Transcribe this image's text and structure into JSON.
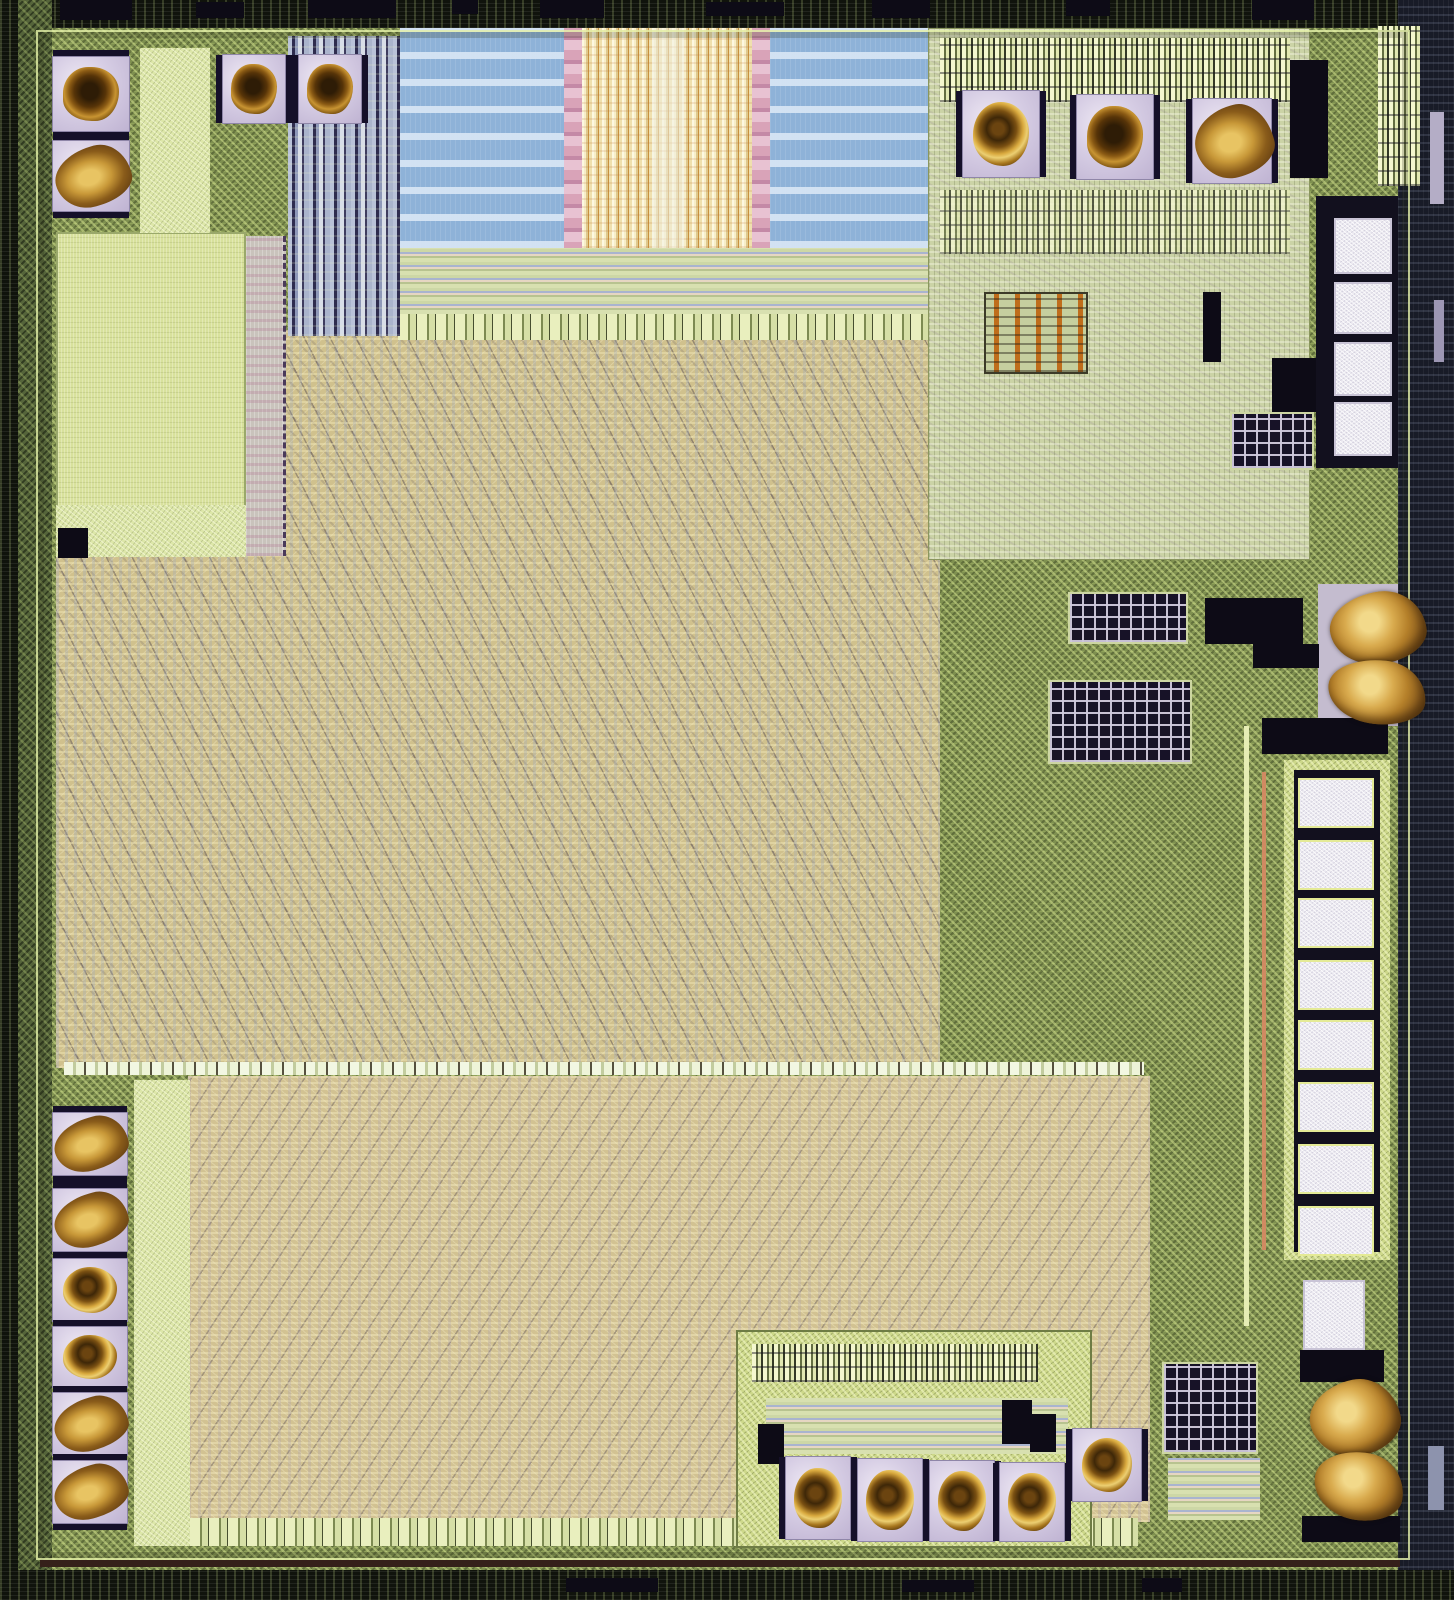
{
  "image": {
    "type": "integrated-circuit die photograph (microscope die shot)",
    "description": "Die photo of a mixed-signal integrated circuit: dark scribe-line border, olive-green seal ring, large tan standard-cell logic fabric split by a pale horizontal routing strip, blue metal capacitor banks with a gold interdigitated structure at top center, pale green memory array at top left, analog macro with resistor and via arrays at top right, wire-bonded gold ball pads on the top, left and bottom edges, gold bond residue smears on the right edge, and columns of unbonded white probe pads on the right side.",
    "width_px": 1454,
    "height_px": 1600
  },
  "palette": {
    "die_edge_dark": "#10130c",
    "die_edge_navy": "#181b27",
    "frame_olive": "#7f9050",
    "frame_bright": "#cdd88a",
    "seal_line": "#e4f0a8",
    "logic_tan": "#d0c18d",
    "logic_blue_gray": "#96a5c3",
    "memory_green": "#d8e19c",
    "capacitor_blue": "#8eb2d8",
    "capacitor_stripe": "#d6e4f4",
    "interdigit_gold": "#c8923f",
    "interdigit_cream": "#f7eec9",
    "interdigit_pink": "#d9a3b8",
    "pad_metal_lavender": "#d6cde4",
    "gold_ball_dark": "#3e2708",
    "gold_ball_ring": "#c89432",
    "gold_smear": "#d9ab4e",
    "probe_pad_white": "#eceaf1",
    "black_block": "#0d0b16",
    "resistor_orange": "#bf6d1c"
  },
  "features": {
    "bond_pad_groups": [
      {
        "name": "top-left-column",
        "count": 2,
        "orientation": "vertical",
        "bonded": true
      },
      {
        "name": "top-left-pair",
        "count": 2,
        "orientation": "horizontal",
        "bonded": true
      },
      {
        "name": "top-right-row",
        "count": 3,
        "orientation": "horizontal",
        "bonded": true
      },
      {
        "name": "left-bottom-column",
        "count": 6,
        "orientation": "vertical",
        "bonded": true
      },
      {
        "name": "bottom-center-row",
        "count": 4,
        "orientation": "horizontal",
        "bonded": true
      },
      {
        "name": "bottom-right-single",
        "count": 1,
        "orientation": "single",
        "bonded": true
      }
    ],
    "probe_pad_columns": [
      {
        "name": "right-upper-column",
        "count": 4
      },
      {
        "name": "right-lower-column",
        "count": 8
      },
      {
        "name": "bottom-right-corner",
        "count": 1
      }
    ],
    "gold_residue_blobs": [
      {
        "name": "right-middle",
        "count": 2
      },
      {
        "name": "bottom-right",
        "count": 2
      }
    ],
    "functional_blocks": [
      "capacitor-bank-left",
      "interdigitated-structure",
      "capacitor-bank-right",
      "memory-array",
      "decoder-column",
      "wiring-channel",
      "analog-macro",
      "resistor-array",
      "via-grid-arrays",
      "logic-fabric-upper",
      "logic-fabric-lower",
      "routing-divider-strip",
      "io-cell-rows",
      "seal-ring"
    ]
  },
  "geometry": {
    "bond_pads": [
      {
        "x": 52,
        "y": 56,
        "w": 78,
        "h": 76,
        "ball": "dark",
        "bars": "v"
      },
      {
        "x": 52,
        "y": 140,
        "w": 78,
        "h": 72,
        "ball": "smear",
        "bars": "v"
      },
      {
        "x": 222,
        "y": 54,
        "w": 64,
        "h": 70,
        "ball": "dark",
        "bars": "h"
      },
      {
        "x": 298,
        "y": 54,
        "w": 64,
        "h": 70,
        "ball": "dark",
        "bars": "h"
      },
      {
        "x": 962,
        "y": 90,
        "w": 78,
        "h": 88,
        "ball": "gold",
        "bars": "h"
      },
      {
        "x": 1076,
        "y": 94,
        "w": 78,
        "h": 86,
        "ball": "dark",
        "bars": "h"
      },
      {
        "x": 1192,
        "y": 98,
        "w": 80,
        "h": 86,
        "ball": "smear",
        "bars": "h"
      },
      {
        "x": 52,
        "y": 1112,
        "w": 76,
        "h": 64,
        "ball": "smear",
        "bars": "v"
      },
      {
        "x": 52,
        "y": 1188,
        "w": 76,
        "h": 64,
        "ball": "smear",
        "bars": "v"
      },
      {
        "x": 52,
        "y": 1258,
        "w": 76,
        "h": 64,
        "ball": "gold",
        "bars": "v"
      },
      {
        "x": 52,
        "y": 1326,
        "w": 76,
        "h": 62,
        "ball": "gold",
        "bars": "v"
      },
      {
        "x": 52,
        "y": 1392,
        "w": 76,
        "h": 64,
        "ball": "smear",
        "bars": "v"
      },
      {
        "x": 52,
        "y": 1460,
        "w": 76,
        "h": 64,
        "ball": "smear",
        "bars": "v"
      },
      {
        "x": 785,
        "y": 1456,
        "w": 66,
        "h": 84,
        "ball": "gold",
        "bars": "h"
      },
      {
        "x": 857,
        "y": 1458,
        "w": 66,
        "h": 84,
        "ball": "gold",
        "bars": "h"
      },
      {
        "x": 929,
        "y": 1460,
        "w": 66,
        "h": 82,
        "ball": "gold",
        "bars": "h"
      },
      {
        "x": 999,
        "y": 1462,
        "w": 66,
        "h": 80,
        "ball": "gold",
        "bars": "h"
      },
      {
        "x": 1072,
        "y": 1428,
        "w": 70,
        "h": 74,
        "ball": "gold",
        "bars": "h"
      }
    ],
    "test_pads": [
      {
        "x": 1334,
        "y": 218,
        "w": 58,
        "h": 56
      },
      {
        "x": 1334,
        "y": 282,
        "w": 58,
        "h": 52
      },
      {
        "x": 1334,
        "y": 342,
        "w": 58,
        "h": 54
      },
      {
        "x": 1334,
        "y": 402,
        "w": 58,
        "h": 54
      },
      {
        "x": 1298,
        "y": 778,
        "w": 76,
        "h": 50,
        "v": "y"
      },
      {
        "x": 1298,
        "y": 840,
        "w": 76,
        "h": 50,
        "v": "y"
      },
      {
        "x": 1298,
        "y": 898,
        "w": 76,
        "h": 50,
        "v": "y"
      },
      {
        "x": 1298,
        "y": 960,
        "w": 76,
        "h": 50,
        "v": "y"
      },
      {
        "x": 1298,
        "y": 1020,
        "w": 76,
        "h": 50,
        "v": "y"
      },
      {
        "x": 1298,
        "y": 1082,
        "w": 76,
        "h": 50,
        "v": "y"
      },
      {
        "x": 1298,
        "y": 1144,
        "w": 76,
        "h": 50,
        "v": "y"
      },
      {
        "x": 1298,
        "y": 1206,
        "w": 76,
        "h": 50,
        "v": "y"
      },
      {
        "x": 1303,
        "y": 1280,
        "w": 62,
        "h": 70
      }
    ],
    "gold_blobs": [
      {
        "x": 1330,
        "y": 592,
        "w": 96,
        "h": 72,
        "rot": -8
      },
      {
        "x": 1328,
        "y": 660,
        "w": 98,
        "h": 64,
        "rot": 6
      },
      {
        "x": 1310,
        "y": 1380,
        "w": 90,
        "h": 76,
        "rot": -12
      },
      {
        "x": 1314,
        "y": 1452,
        "w": 90,
        "h": 68,
        "rot": 10
      }
    ],
    "dark_blocks": [
      {
        "x": 60,
        "y": 0,
        "w": 72,
        "h": 20
      },
      {
        "x": 196,
        "y": 2,
        "w": 48,
        "h": 16
      },
      {
        "x": 308,
        "y": 0,
        "w": 88,
        "h": 18
      },
      {
        "x": 452,
        "y": 0,
        "w": 26,
        "h": 14
      },
      {
        "x": 540,
        "y": 0,
        "w": 64,
        "h": 18
      },
      {
        "x": 706,
        "y": 2,
        "w": 78,
        "h": 14
      },
      {
        "x": 872,
        "y": 0,
        "w": 58,
        "h": 18
      },
      {
        "x": 1066,
        "y": 0,
        "w": 44,
        "h": 16
      },
      {
        "x": 1252,
        "y": 0,
        "w": 62,
        "h": 20
      },
      {
        "x": 1290,
        "y": 60,
        "w": 38,
        "h": 118
      },
      {
        "x": 1203,
        "y": 292,
        "w": 18,
        "h": 70
      },
      {
        "x": 1272,
        "y": 358,
        "w": 44,
        "h": 54
      },
      {
        "x": 1205,
        "y": 598,
        "w": 98,
        "h": 46
      },
      {
        "x": 1253,
        "y": 644,
        "w": 66,
        "h": 24
      },
      {
        "x": 1262,
        "y": 718,
        "w": 126,
        "h": 36
      },
      {
        "x": 58,
        "y": 528,
        "w": 30,
        "h": 30
      },
      {
        "x": 758,
        "y": 1424,
        "w": 26,
        "h": 40
      },
      {
        "x": 1002,
        "y": 1400,
        "w": 30,
        "h": 44
      },
      {
        "x": 1030,
        "y": 1414,
        "w": 26,
        "h": 38
      },
      {
        "x": 1300,
        "y": 1350,
        "w": 84,
        "h": 32
      },
      {
        "x": 1302,
        "y": 1516,
        "w": 98,
        "h": 26
      },
      {
        "x": 566,
        "y": 1578,
        "w": 92,
        "h": 14
      },
      {
        "x": 902,
        "y": 1580,
        "w": 72,
        "h": 12
      },
      {
        "x": 1142,
        "y": 1578,
        "w": 40,
        "h": 14
      }
    ],
    "via_grids": [
      {
        "x": 1230,
        "y": 412,
        "w": 84,
        "h": 58
      },
      {
        "x": 1068,
        "y": 592,
        "w": 120,
        "h": 52
      },
      {
        "x": 1048,
        "y": 680,
        "w": 144,
        "h": 84
      },
      {
        "x": 1162,
        "y": 1362,
        "w": 96,
        "h": 92
      }
    ],
    "streaks": [
      {
        "x": 1430,
        "y": 112,
        "w": 14,
        "h": 92,
        "c": "#b4adc6"
      },
      {
        "x": 1434,
        "y": 300,
        "w": 10,
        "h": 62,
        "c": "#9d97b4"
      },
      {
        "x": 1428,
        "y": 1446,
        "w": 16,
        "h": 64,
        "c": "#8d93ad"
      },
      {
        "x": 1262,
        "y": 772,
        "w": 4,
        "h": 478,
        "c": "#d08a62"
      },
      {
        "x": 1244,
        "y": 726,
        "w": 5,
        "h": 600,
        "c": "#e6edb4"
      }
    ]
  }
}
